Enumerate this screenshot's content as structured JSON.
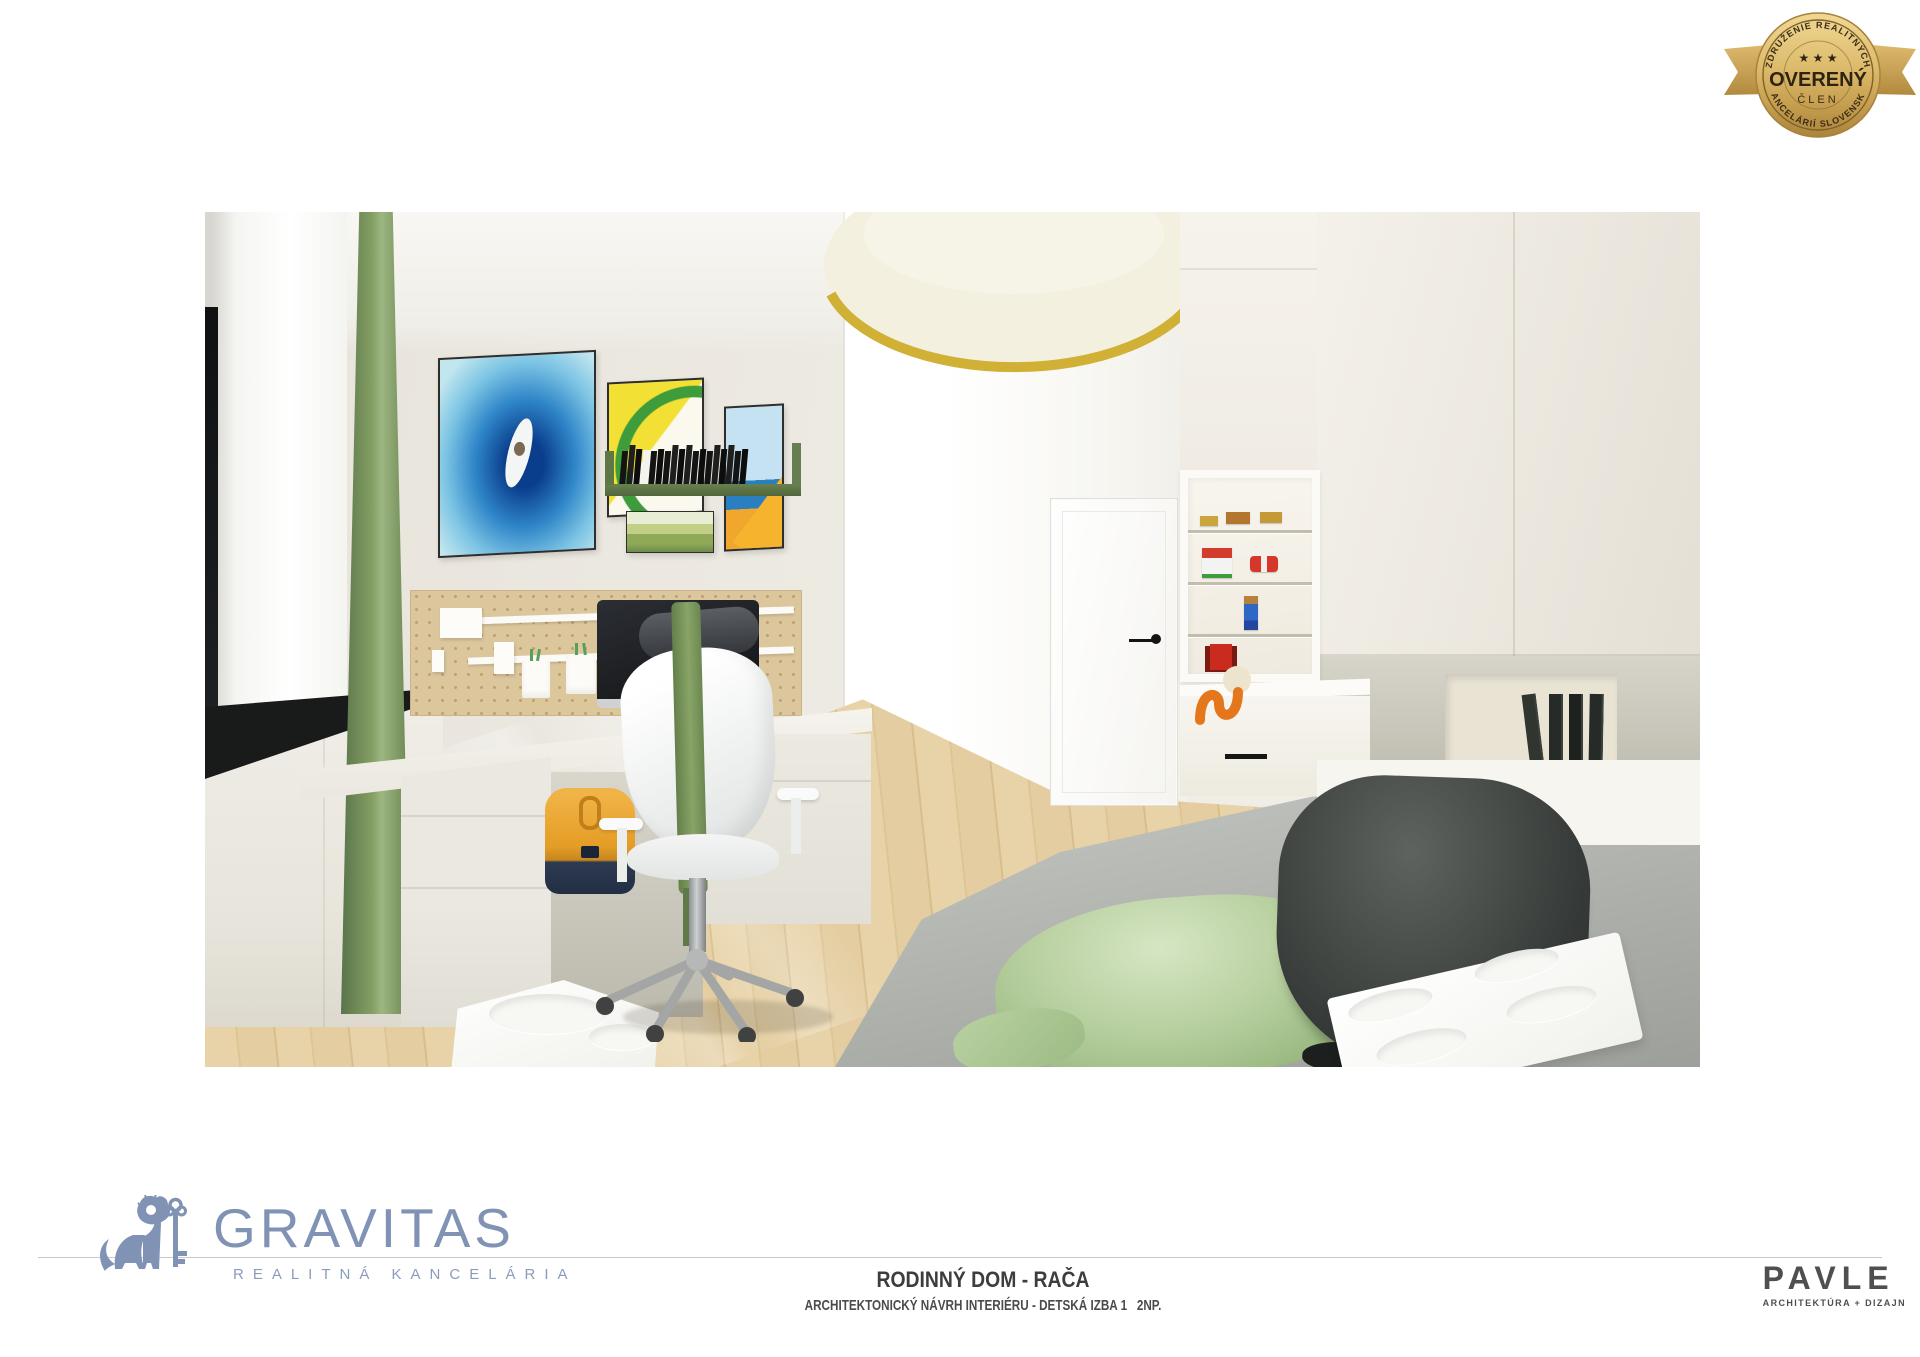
{
  "badge": {
    "arc_top": "ZDRUŽENIE REALITNÝCH",
    "arc_bottom": "KANCELÁRIÍ SLOVENSKA",
    "stars": "★ ★ ★",
    "title": "OVERENÝ",
    "subtitle": "ČLEN",
    "gold_color": "#d2ac5e"
  },
  "project": {
    "title": "RODINNÝ DOM - RAČA",
    "subtitle": "ARCHITEKTONICKÝ NÁVRH INTERIÉRU - DETSKÁ IZBA 1   2NP."
  },
  "gravitas": {
    "name": "GRAVITAS",
    "tagline": "REALITNÁ KANCELÁRIA",
    "brand_color": "#8093b4"
  },
  "pavle": {
    "name": "PAVLE",
    "tagline": "ARCHITEKTÚRA + DIZAJN",
    "color": "#4f4f4f"
  },
  "render_colors": {
    "curtain_green": "#76915a",
    "light_rim_yellow": "#d0b135",
    "floor_wood": "#e0c99c",
    "backpack_orange": "#e49d26",
    "pouf_charcoal": "#3a3e3c",
    "pillow_green": "#b6cf9f"
  }
}
